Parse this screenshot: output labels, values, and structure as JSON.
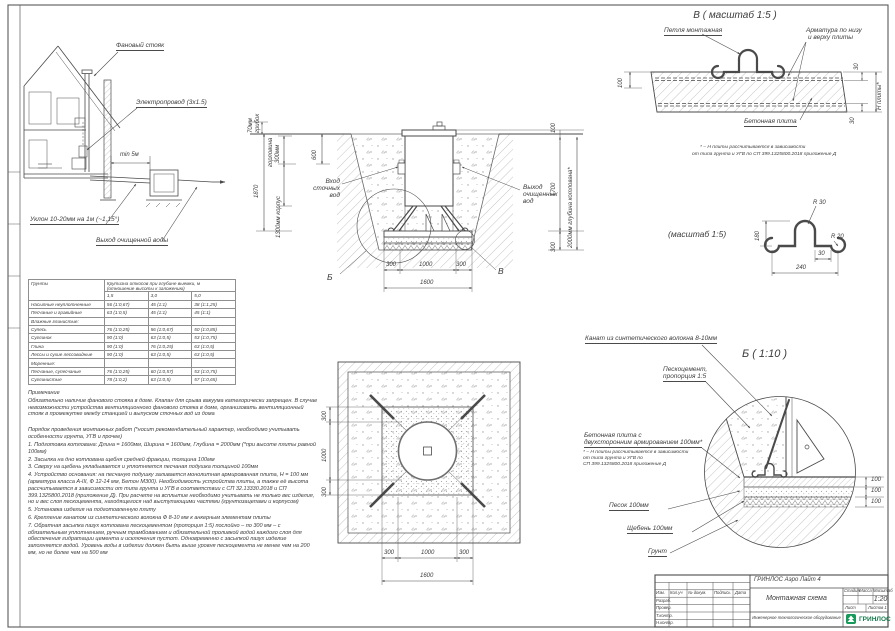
{
  "house": {
    "vent_label": "Фановый стояк",
    "wire_label": "Электропровод (3х1.5)",
    "min_dist": "min 5м",
    "slope_label": "Уклон 10-20мм на 1м (~1,15°)",
    "outlet_label": "Выход очищенной воды"
  },
  "section": {
    "cap1": "70мм",
    "cap2": "грибок",
    "neck1": "горловина",
    "neck2": "300мм",
    "total_h": "1870",
    "body_h": "1300мм корпус",
    "d600": "600",
    "d100": "100",
    "d1700": "1700",
    "d300r": "300",
    "depth": "2000мм глубина котлована*",
    "inlet1": "Вход",
    "inlet2": "сточных",
    "inlet3": "вод",
    "outlet1": "Выход",
    "outlet2": "очищенных",
    "outlet3": "вод",
    "b300l": "300",
    "b1000": "1000",
    "b300r": "300",
    "b1600": "1600",
    "callout_b": "Б",
    "callout_v": "В"
  },
  "detail_v": {
    "title": "В ( масштаб 1:5 )",
    "loop_label": "Петля монтажная",
    "rebar1": "Арматура по низу",
    "rebar2": "и верху плиты",
    "slab_label": "Бетонная плита",
    "d100": "100",
    "d30t": "30",
    "d30b": "30",
    "dh": "Н плиты*",
    "fn1": "* – Н плиты рассчитывается в зависимости",
    "fn2": "от типа грунта и УГВ по СП 399.1325800.2018 приложение Д"
  },
  "detail_loop": {
    "title": "(масштаб 1:5)",
    "r30": "R 30",
    "r20": "R 20",
    "d180": "180",
    "d30": "30",
    "d240": "240"
  },
  "detail_b": {
    "title": "Б ( 1:10 )",
    "rope": "Канат из синтетического волокна 8-10мм",
    "sc1": "Пескоцемент,",
    "sc2": "пропорция 1:5",
    "slab1": "Бетонная плита с",
    "slab2": "двухсторонним армированием 100мм*",
    "fn1": "* – Н плиты рассчитывается в зависимости",
    "fn2": "от типа грунта и УГВ по",
    "fn3": "СП 399.1325800.2018 приложение Д",
    "sand": "Песок 100мм",
    "gravel": "Щебень 100мм",
    "soil": "Грунт",
    "d100a": "100",
    "d100b": "100",
    "d100c": "100"
  },
  "soils_table": {
    "col_soil": "Грунты",
    "head1": "Крутизна откосов при глубине выемки, м",
    "head2": "(отношение высоты к заложению)",
    "sub1": "1,5",
    "sub2": "3,0",
    "sub3": "5,0",
    "rows": [
      {
        "n": "Насыпные неуплотненные",
        "a": "56 (1:0,67)",
        "b": "45 (1:1)",
        "c": "38 (1:1,25)"
      },
      {
        "n": "Песчаные и гравийные",
        "a": "63 (1:0,5)",
        "b": "45 (1:1)",
        "c": "45 (1:1)"
      },
      {
        "n": "Влажные глинистые:",
        "a": "",
        "b": "",
        "c": ""
      },
      {
        "n": "Супесь",
        "a": "76 (1:0,25)",
        "b": "56 (1:0,67)",
        "c": "50 (1:0,85)"
      },
      {
        "n": "Суглинок",
        "a": "90 (1:0)",
        "b": "63 (1:0,5)",
        "c": "53 (1:0,75)"
      },
      {
        "n": "Глина",
        "a": "90 (1:0)",
        "b": "76 (1:0,25)",
        "c": "63 (1:0,5)"
      },
      {
        "n": "Лессы и сухие лессовидные",
        "a": "90 (1:0)",
        "b": "63 (1:0,5)",
        "c": "63 (1:0,5)"
      },
      {
        "n": "Моренные:",
        "a": "",
        "b": "",
        "c": ""
      },
      {
        "n": "Песчаные, супесчаные",
        "a": "76 (1:0,25)",
        "b": "60 (1:0,57)",
        "c": "53 (1:0,75)"
      },
      {
        "n": "Суглинистые",
        "a": "78 (1:0,2)",
        "b": "63 (1:0,5)",
        "c": "57 (1:0,65)"
      }
    ]
  },
  "notes": {
    "heading": "Примечание",
    "p1": "Обязательно наличие фанового стояка в доме. Клапан для срыва вакуума категорически запрещен. В случае невозможности устройства вентиляционного фанового стояка в доме, организовать вентиляционный стояк в промежутке между станцией и выпуском сточных вод из дома",
    "p2": "Порядок проведения монтажных работ (*носит рекомендательный характер, необходимо учитывать особенности грунта, УГВ и прочее)",
    "items": [
      "1. Подготовка котлована: Длина = 1600мм,  Ширина = 1600мм, Глубина = 2000мм (*при высоте плиты равной 100мм)",
      "2. Засыпка на дно котлована щебня средней фракции, толщина 100мм",
      "3. Сверху на щебень укладывается и уплотняется песчаная подушка толщиной 100мм",
      "4. Устройство основания: на песчаную подушку заливается монолитная армированная плита, Н = 100 мм (арматура класса А-III, Ф 12-14 мм, Бетон М300). Необходимость устройства плиты, а также её высота рассчитывается в зависимости от типа грунта и УГВ в соответствии с СП 32.13330.2018 и СП 399.1325800.2018 (приложение Д). При расчете на всплытие  необходимо учитывать не только вес изделия, но и вес слоя пескоцемента, находящегося над выступающими частями (грунтозацепами и корпусом)",
      "5. Установка изделия на подготовленную плиту",
      "6. Крепление канатом из синтетического волокна Ф 8-10 мм к анкерным элементам плиты",
      "7. Обратная засыпка пазух котлована пескоцементом (пропорция 1:5) послойно – по 300 мм – с обязательным уплотнением, ручным трамбованием и обязательной проливкой водой каждого слоя для обеспечения гидратации цемента и исключения пустот. Одновременно с засыпкой пазух изделие заполняется водой. Уровень воды в изделии должен быть выше уровня пескоцемента не менее чем на 200 мм, но не более чем на 500 мм"
    ]
  },
  "plan": {
    "l300a": "300",
    "l1000": "1000",
    "l300b": "300",
    "b300a": "300",
    "b1000": "1000",
    "b300b": "300",
    "b1600": "1600"
  },
  "title_block": {
    "product": "ГРИНЛОС Аэро Лайт 4",
    "doc": "Монтажная схема",
    "category": "Инженерное технологическое оборудование",
    "h_stage": "Стадия",
    "h_mass": "Масса",
    "h_scale": "Масштаб",
    "scale": "1:20",
    "h_sheet": "Лист",
    "h_sheets": "Листов 1",
    "sig_h1": "Изм.",
    "sig_h2": "Кол.уч",
    "sig_h3": "№ докум.",
    "sig_h4": "Подпись",
    "sig_h5": "Дата",
    "sig_r1": "Разраб.",
    "sig_r2": "Провер.",
    "sig_r3": "Т.контр.",
    "sig_r4": "Н.контр.",
    "sig_r5": "Утв.",
    "logo": "ГРИНЛОС"
  }
}
